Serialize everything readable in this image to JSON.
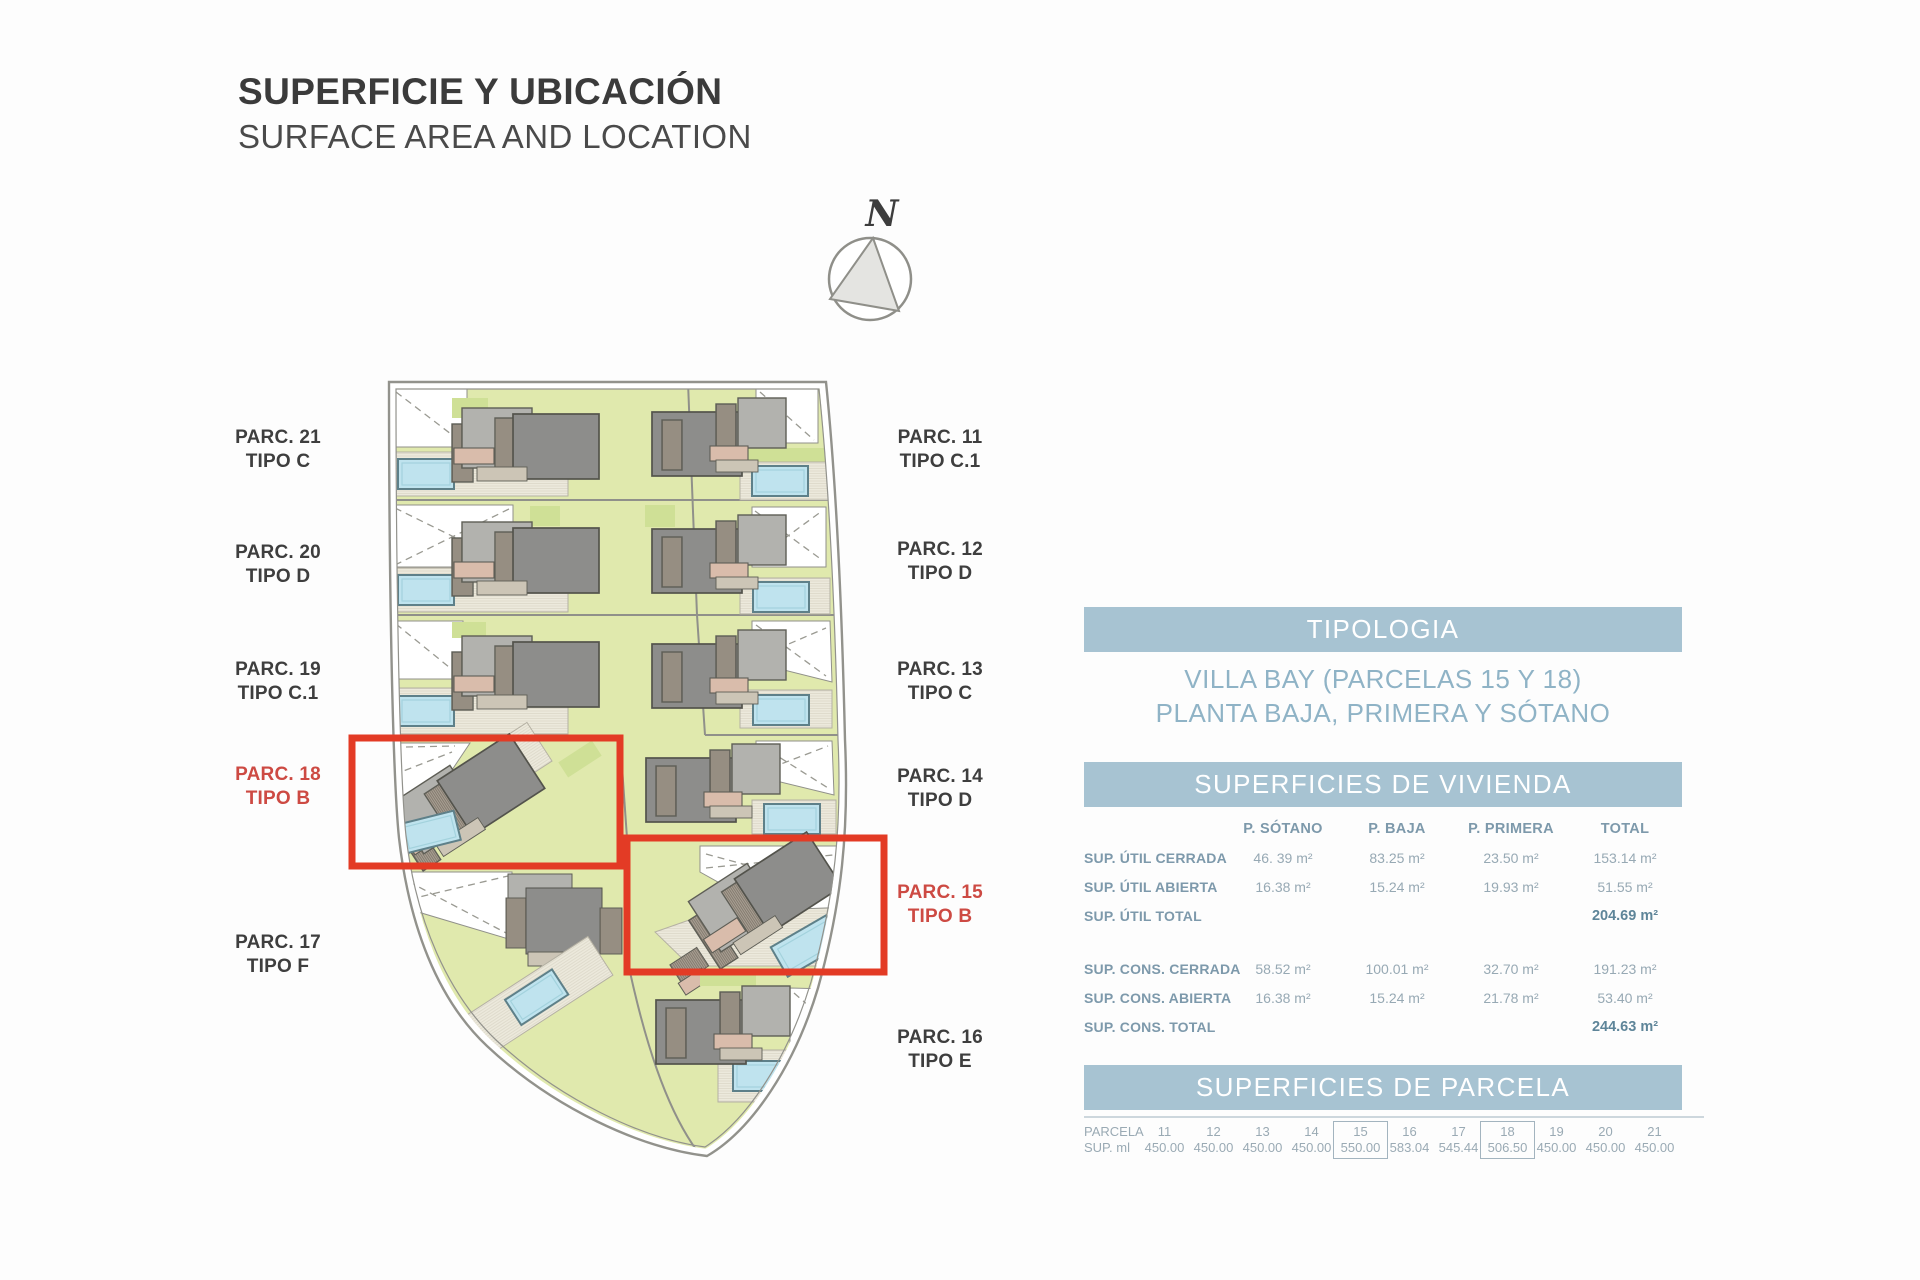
{
  "title": {
    "main": "SUPERFICIE Y UBICACIÓN",
    "sub": "SURFACE AREA AND LOCATION"
  },
  "compass": {
    "label": "N"
  },
  "site_plan": {
    "labels": [
      {
        "parc": "PARC. 21",
        "tipo": "TIPO C",
        "highlighted": false
      },
      {
        "parc": "PARC. 20",
        "tipo": "TIPO D",
        "highlighted": false
      },
      {
        "parc": "PARC. 19",
        "tipo": "TIPO C.1",
        "highlighted": false
      },
      {
        "parc": "PARC. 18",
        "tipo": "TIPO B",
        "highlighted": true
      },
      {
        "parc": "PARC. 17",
        "tipo": "TIPO F",
        "highlighted": false
      },
      {
        "parc": "PARC. 11",
        "tipo": "TIPO C.1",
        "highlighted": false
      },
      {
        "parc": "PARC. 12",
        "tipo": "TIPO D",
        "highlighted": false
      },
      {
        "parc": "PARC. 13",
        "tipo": "TIPO C",
        "highlighted": false
      },
      {
        "parc": "PARC. 14",
        "tipo": "TIPO D",
        "highlighted": false
      },
      {
        "parc": "PARC. 15",
        "tipo": "TIPO B",
        "highlighted": true
      },
      {
        "parc": "PARC. 16",
        "tipo": "TIPO E",
        "highlighted": false
      }
    ]
  },
  "panel": {
    "tipologia": {
      "header": "TIPOLOGIA",
      "line1": "VILLA BAY (PARCELAS 15 Y 18)",
      "line2": "PLANTA BAJA, PRIMERA Y SÓTANO"
    },
    "vivienda": {
      "header": "SUPERFICIES DE VIVIENDA",
      "columns": [
        "P. SÓTANO",
        "P. BAJA",
        "P. PRIMERA",
        "TOTAL"
      ],
      "rows": [
        {
          "label": "SUP. ÚTIL CERRADA",
          "values": [
            "46. 39 m²",
            "83.25 m²",
            "23.50 m²",
            "153.14 m²"
          ]
        },
        {
          "label": "SUP. ÚTIL ABIERTA",
          "values": [
            "16.38 m²",
            "15.24 m²",
            "19.93 m²",
            "51.55 m²"
          ]
        },
        {
          "label": "SUP. ÚTIL TOTAL",
          "values": [
            "",
            "",
            "",
            "204.69 m²"
          ]
        },
        {
          "label": "SUP. CONS. CERRADA",
          "values": [
            "58.52 m²",
            "100.01 m²",
            "32.70 m²",
            "191.23 m²"
          ]
        },
        {
          "label": "SUP. CONS. ABIERTA",
          "values": [
            "16.38 m²",
            "15.24 m²",
            "21.78 m²",
            "53.40 m²"
          ]
        },
        {
          "label": "SUP. CONS. TOTAL",
          "values": [
            "",
            "",
            "",
            "244.63 m²"
          ]
        }
      ]
    },
    "parcela": {
      "header": "SUPERFICIES DE PARCELA",
      "row_labels": [
        "PARCELA",
        "SUP. ml"
      ],
      "columns": [
        {
          "num": "11",
          "value": "450.00",
          "boxed": false
        },
        {
          "num": "12",
          "value": "450.00",
          "boxed": false
        },
        {
          "num": "13",
          "value": "450.00",
          "boxed": false
        },
        {
          "num": "14",
          "value": "450.00",
          "boxed": false
        },
        {
          "num": "15",
          "value": "550.00",
          "boxed": true
        },
        {
          "num": "16",
          "value": "583.04",
          "boxed": false
        },
        {
          "num": "17",
          "value": "545.44",
          "boxed": false
        },
        {
          "num": "18",
          "value": "506.50",
          "boxed": true
        },
        {
          "num": "19",
          "value": "450.00",
          "boxed": false
        },
        {
          "num": "20",
          "value": "450.00",
          "boxed": false
        },
        {
          "num": "21",
          "value": "450.00",
          "boxed": false
        }
      ]
    }
  },
  "colors": {
    "accent_bar": "#a7c3d2",
    "highlight_red": "#e33b25",
    "red_label_text": "#cd4a43",
    "lawn_green": "#e0e9ad",
    "pool_blue": "#bfe3ee",
    "table_text_blue": "#7d99ab"
  }
}
